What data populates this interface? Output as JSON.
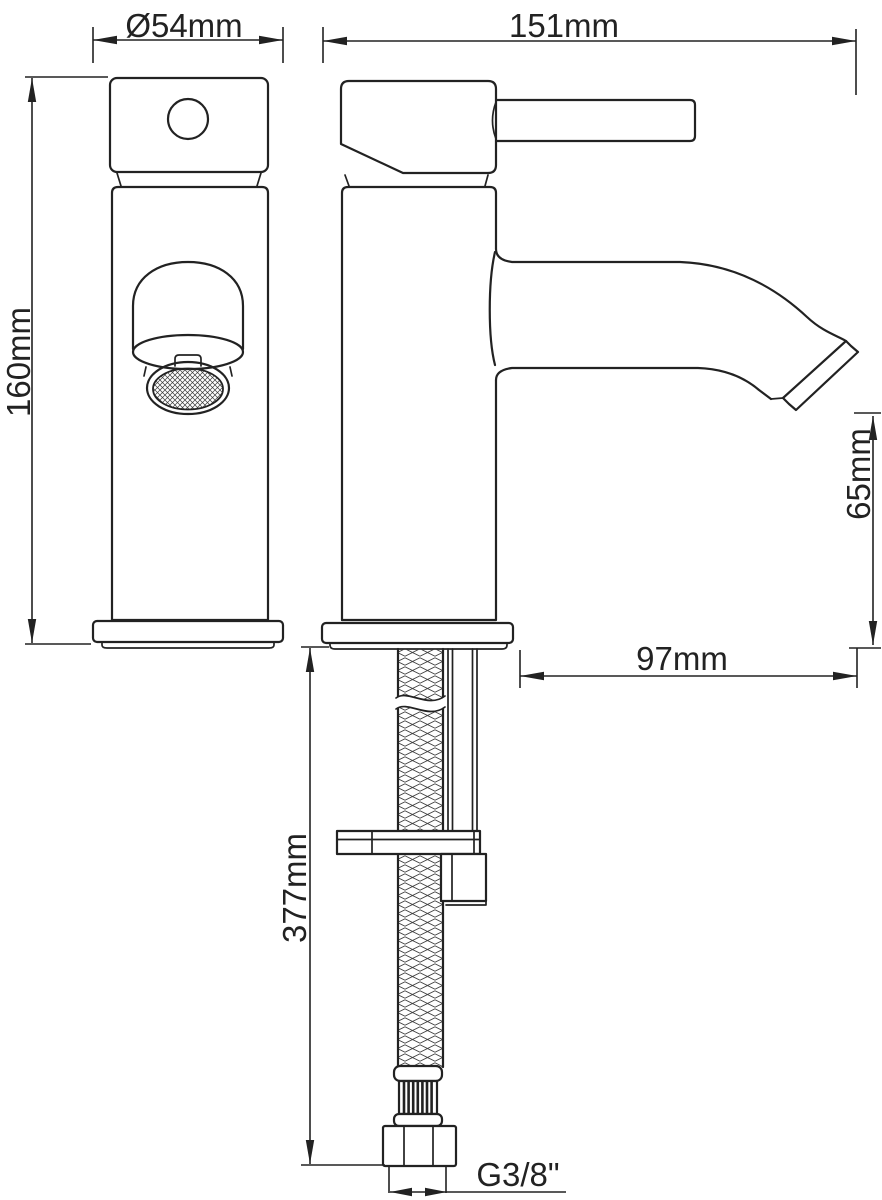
{
  "drawing": {
    "background": "#ffffff",
    "line_color": "#222222",
    "dimensions": {
      "base_diameter": "Ø54mm",
      "total_length": "151mm",
      "body_height": "160mm",
      "spout_height": "65mm",
      "spout_reach": "97mm",
      "hose_length": "377mm",
      "thread_size": "G3/8\""
    }
  }
}
